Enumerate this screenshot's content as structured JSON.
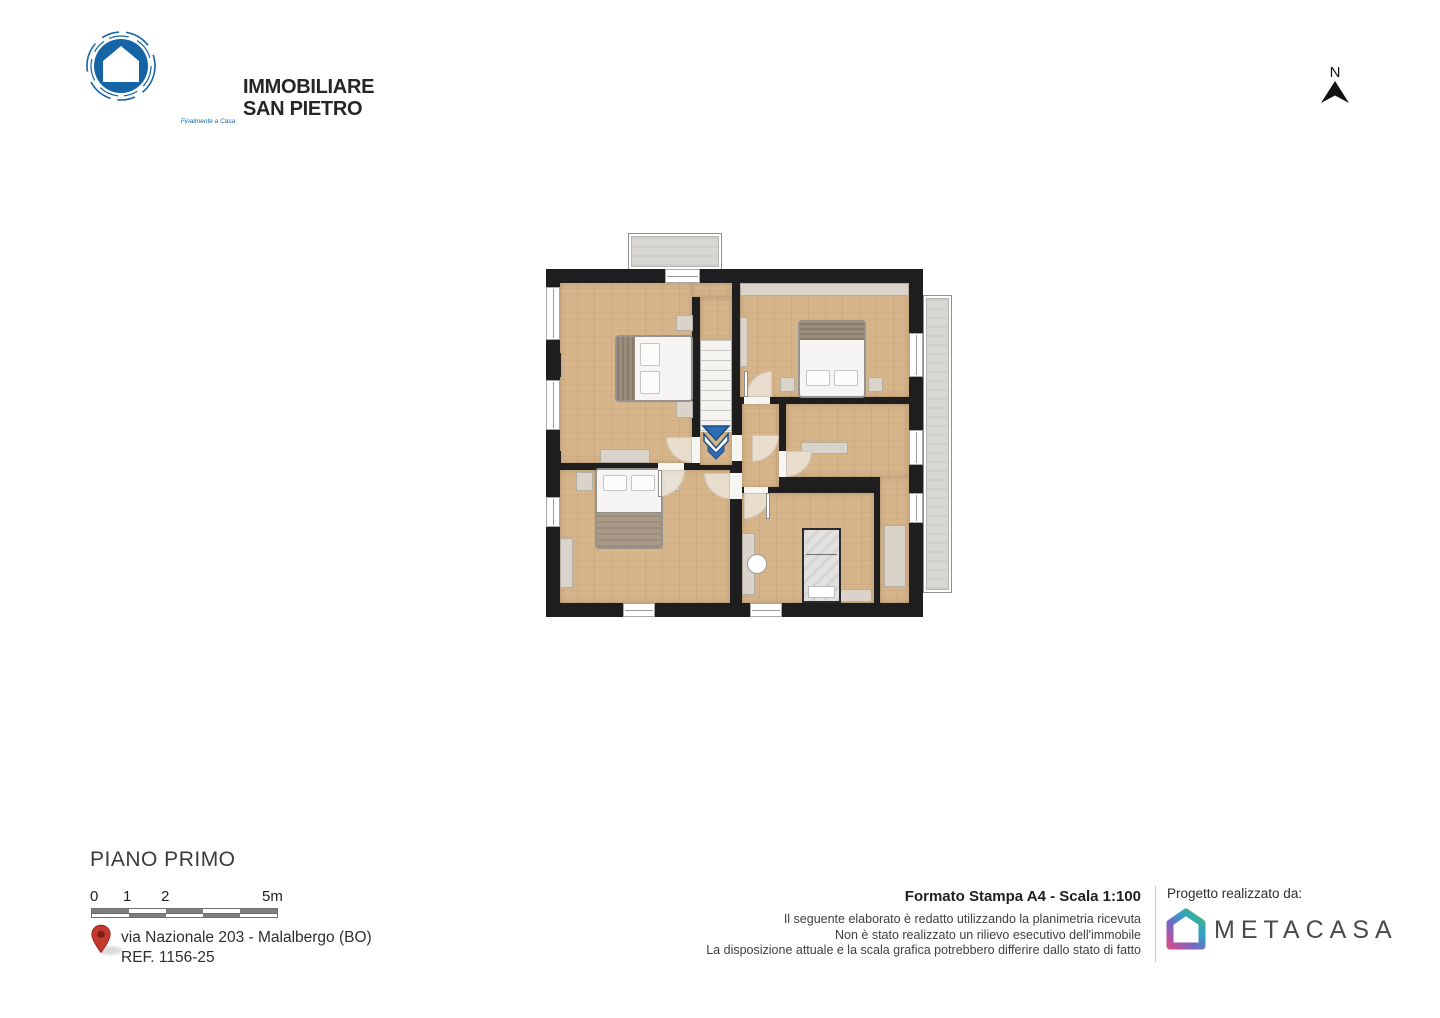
{
  "header": {
    "logo_line1": "IMMOBILIARE",
    "logo_line2": "SAN PIETRO",
    "logo_tagline": "Finalmente a Casa",
    "compass_label": "N"
  },
  "footer": {
    "floor_title": "PIANO PRIMO",
    "scale_labels": [
      "0",
      "1",
      "2",
      "5m"
    ],
    "address_line1": "via Nazionale 203 - Malalbergo (BO)",
    "address_line2": "REF. 1156-25",
    "print_format": "Formato Stampa A4 - Scala 1:100",
    "disclaimer_line1": "Il seguente elaborato è redatto utilizzando la planimetria ricevuta",
    "disclaimer_line2": "Non è stato realizzato un rilievo esecutivo dell'immobile",
    "disclaimer_line3": "La disposizione attuale e la scala grafica potrebbero differire dallo stato di fatto",
    "credit_label": "Progetto realizzato da:",
    "credit_brand": "METACASA"
  },
  "icons": {
    "agency_logo": "san-pietro-house-logo-icon",
    "north": "north-arrow-icon",
    "location": "location-pin-icon",
    "stairs_direction": "stairs-down-arrow-icon",
    "credit_logo": "metacasa-house-logo-icon"
  },
  "colors": {
    "logo_blue": "#1565a6",
    "wall_black": "#1e1e1e",
    "wood_floor": "#d7b58b",
    "balcony_gray": "#d8d7d4",
    "furniture_beige": "#d9d3c9",
    "arrow_blue": "#2d6db4",
    "pin_red": "#c43a2f",
    "scale_dark": "#7e7e7e",
    "metacasa_text": "#4a4a4a"
  }
}
